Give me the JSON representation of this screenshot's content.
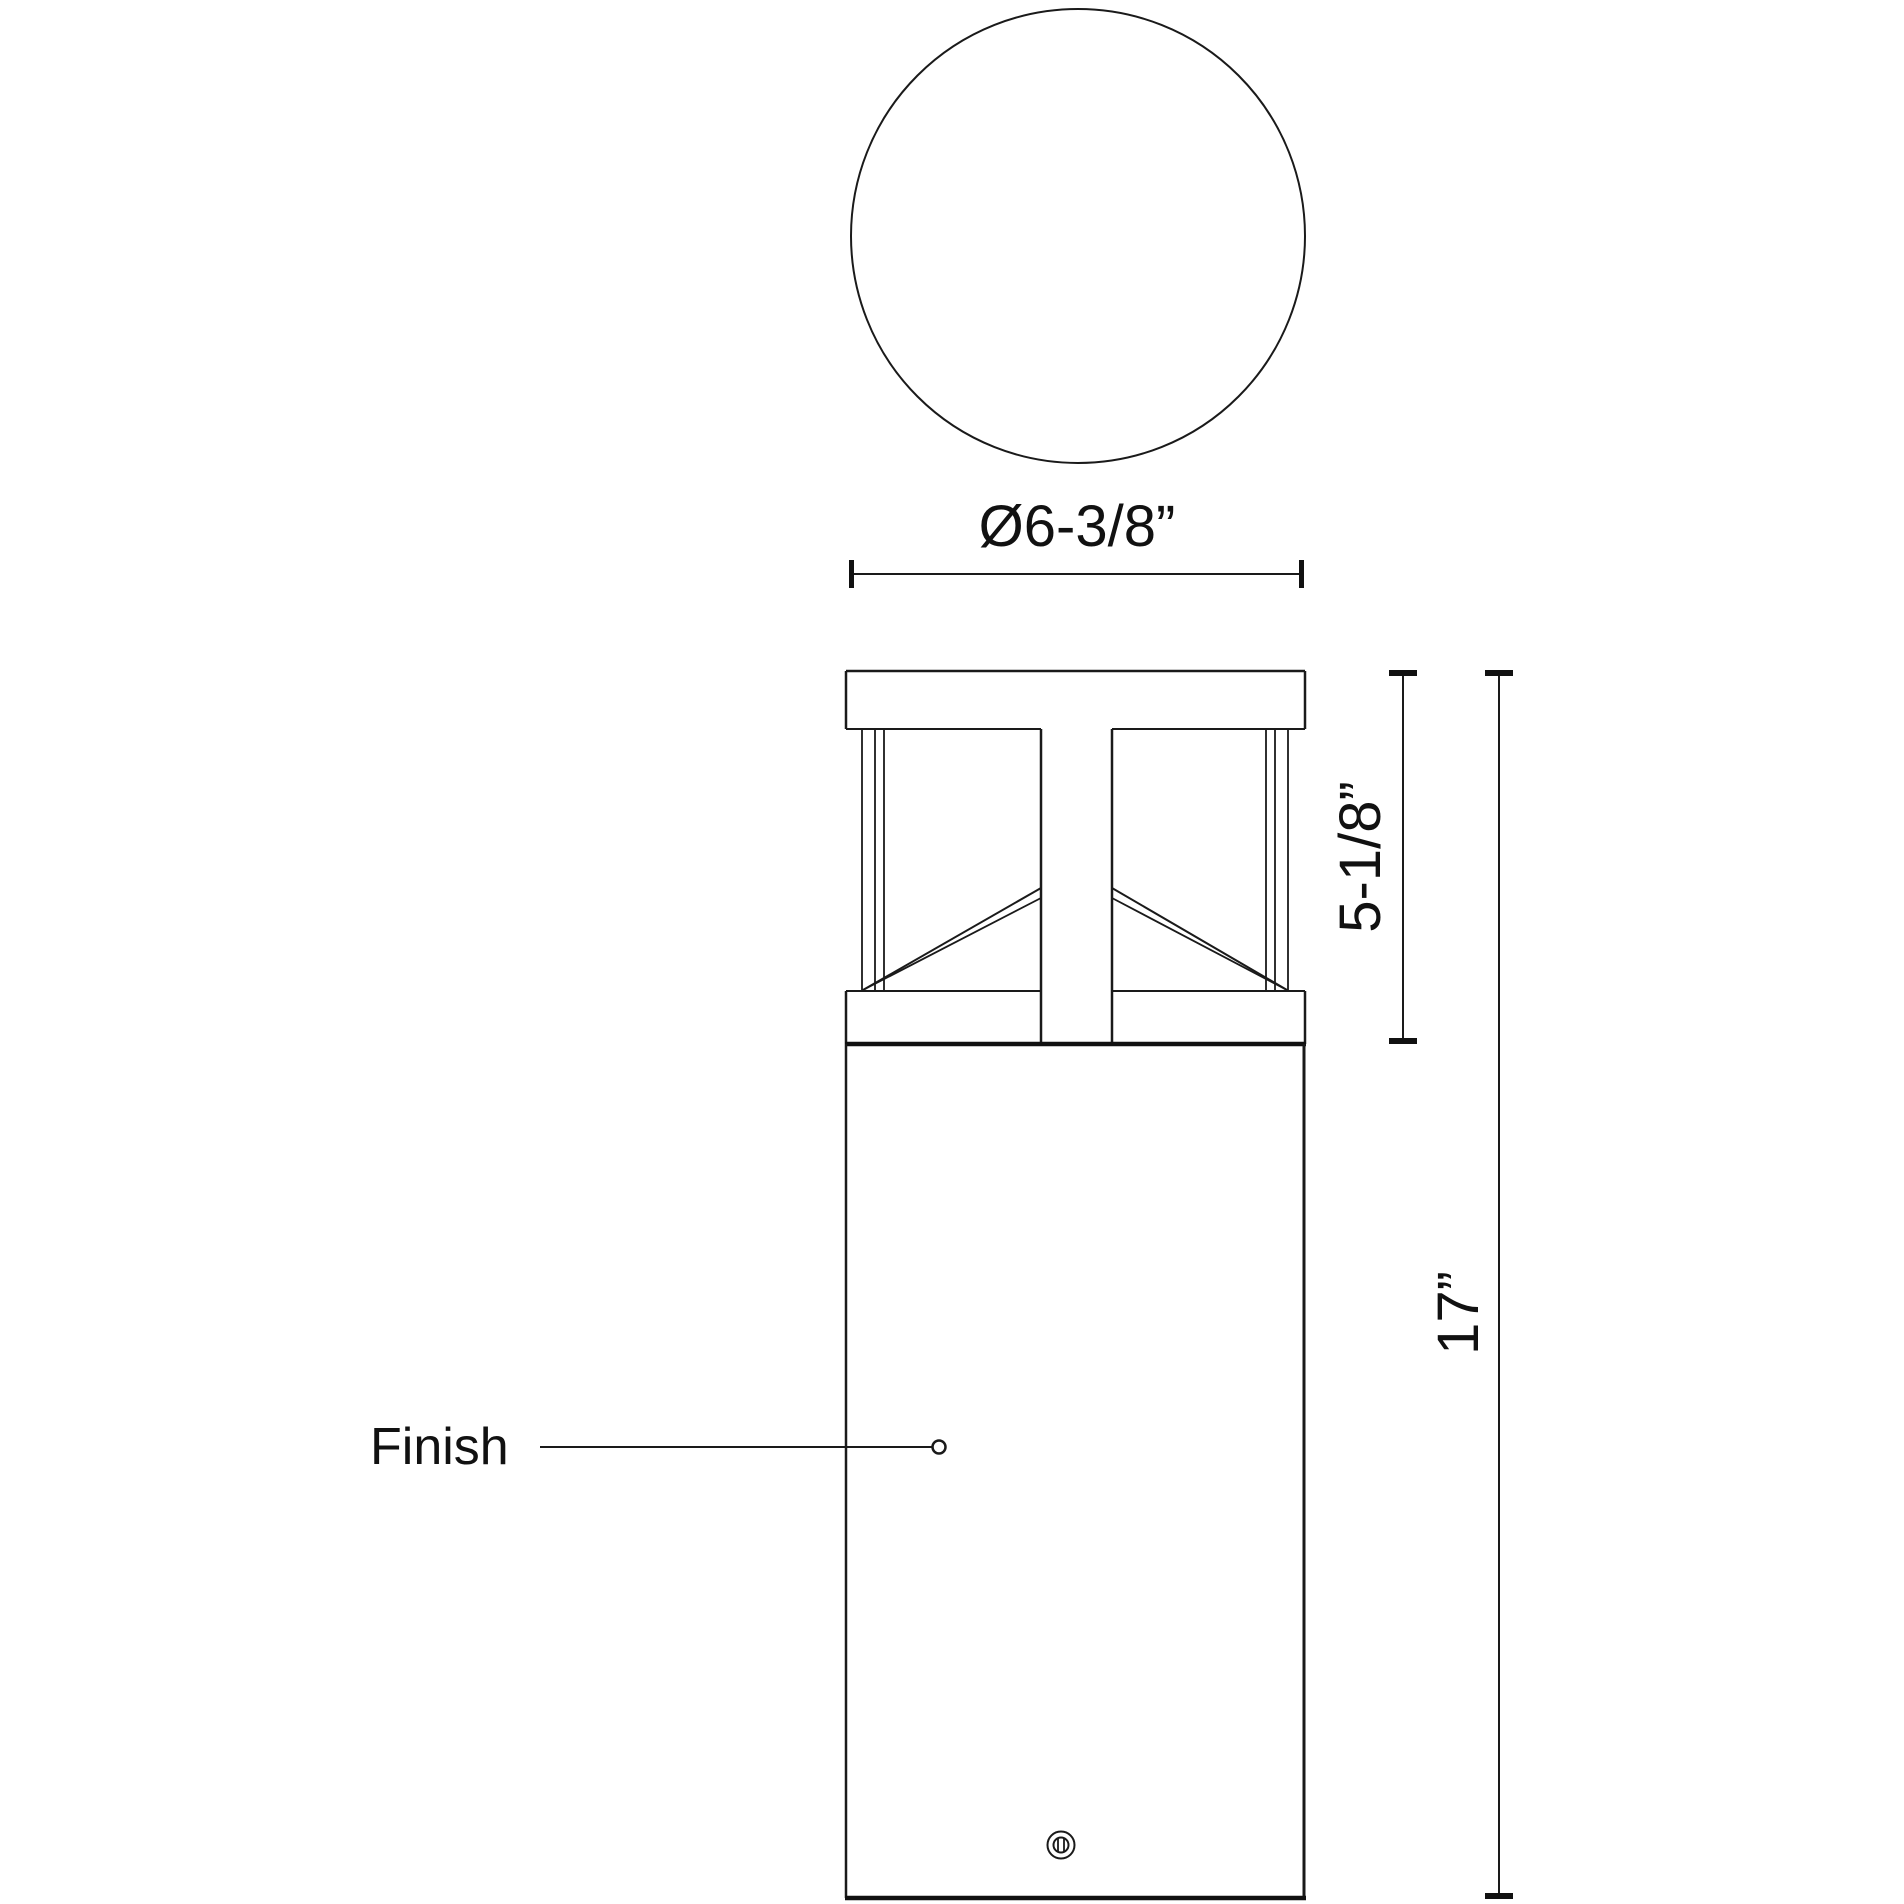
{
  "views": {
    "top": {
      "diameter_dim": "Ø6-3/8”"
    },
    "front": {
      "head_height_dim": "5-1/8”",
      "overall_height_dim": "17”",
      "finish_label": "Finish"
    }
  },
  "colors": {
    "line": "#1a1a1a",
    "background": "#ffffff"
  }
}
